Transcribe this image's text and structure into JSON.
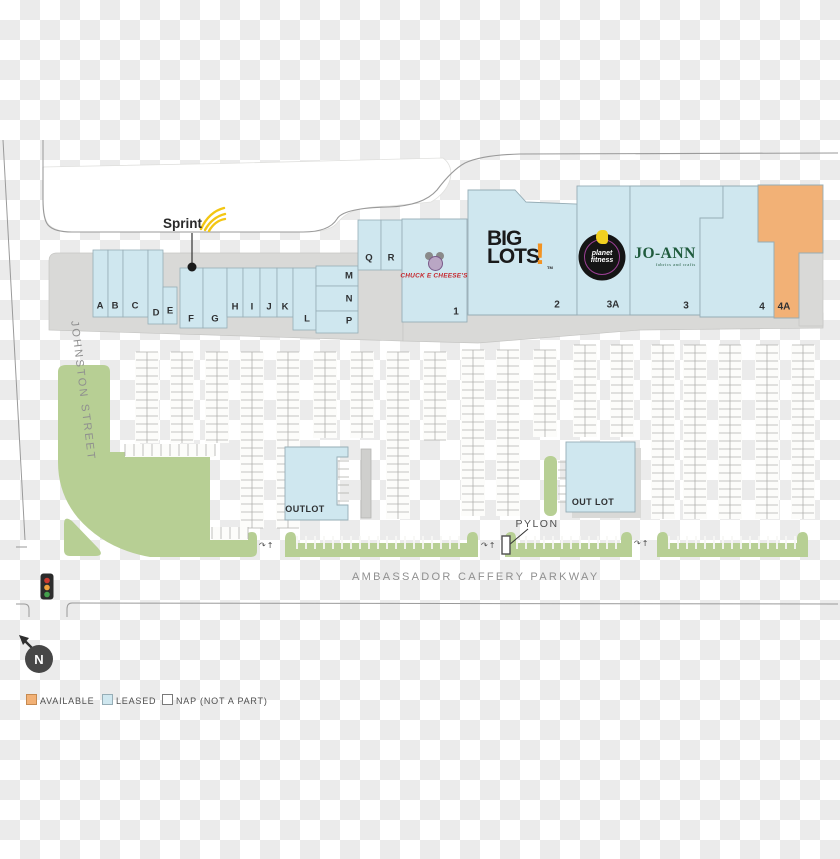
{
  "legend": {
    "available": "AVAILABLE",
    "leased": "LEASED",
    "nap": "NAP (NOT A PART)"
  },
  "streets": {
    "left": "JOHNSTON STREET",
    "bottom": "AMBASSADOR CAFFERY PARKWAY"
  },
  "labels": {
    "pylon": "PYLON",
    "outlot_west": "OUTLOT",
    "outlot_east": "OUT LOT",
    "north": "N",
    "sprint": "Sprint"
  },
  "tenants": {
    "chuck": "CHUCK E CHEESE'S",
    "biglots_top": "BIG",
    "biglots_bottom": "LOTS",
    "biglots_bang": "!",
    "planet_line1": "planet",
    "planet_line2": "fitness",
    "joann": "JO-ANN",
    "joann_tag": "fabrics and crafts"
  },
  "units": {
    "strip": [
      "A",
      "B",
      "C",
      "D",
      "E",
      "F",
      "G",
      "H",
      "I",
      "J",
      "K",
      "L",
      "M",
      "N",
      "P",
      "Q",
      "R"
    ],
    "anchors": [
      "1",
      "2",
      "3A",
      "3",
      "4",
      "4A"
    ]
  },
  "colors": {
    "available": "#f2b176",
    "leased": "#cfe7ef",
    "pad": "#d9d9d7",
    "green": "#b7cf94",
    "outline": "#9a9a9a"
  }
}
